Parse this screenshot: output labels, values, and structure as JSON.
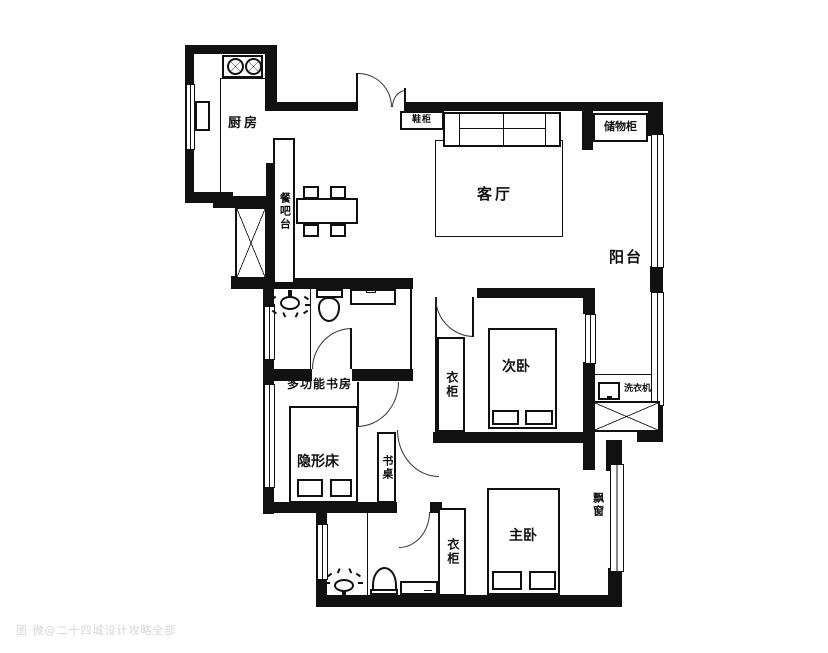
{
  "floorplan": {
    "room_labels": {
      "kitchen": "厨房",
      "living_room": "客厅",
      "balcony": "阳台",
      "study": "多功能书房",
      "secondary_bedroom": "次卧",
      "master_bedroom": "主卧"
    },
    "fixture_labels": {
      "dining_bar": "餐吧台",
      "shoe_cabinet": "鞋柜",
      "storage_cabinet": "储物柜",
      "wardrobe_secondary": "衣柜",
      "wardrobe_master": "衣柜",
      "washing_machine": "洗衣机",
      "hidden_bed": "隐形床",
      "desk": "书桌",
      "bay_window": "飘窗"
    },
    "watermark": "图·微@二十四城设计攻略全部",
    "colors": {
      "wall": "#111111",
      "background": "#ffffff",
      "door_arc": "#333333",
      "watermark": "#d6d6d6"
    }
  }
}
